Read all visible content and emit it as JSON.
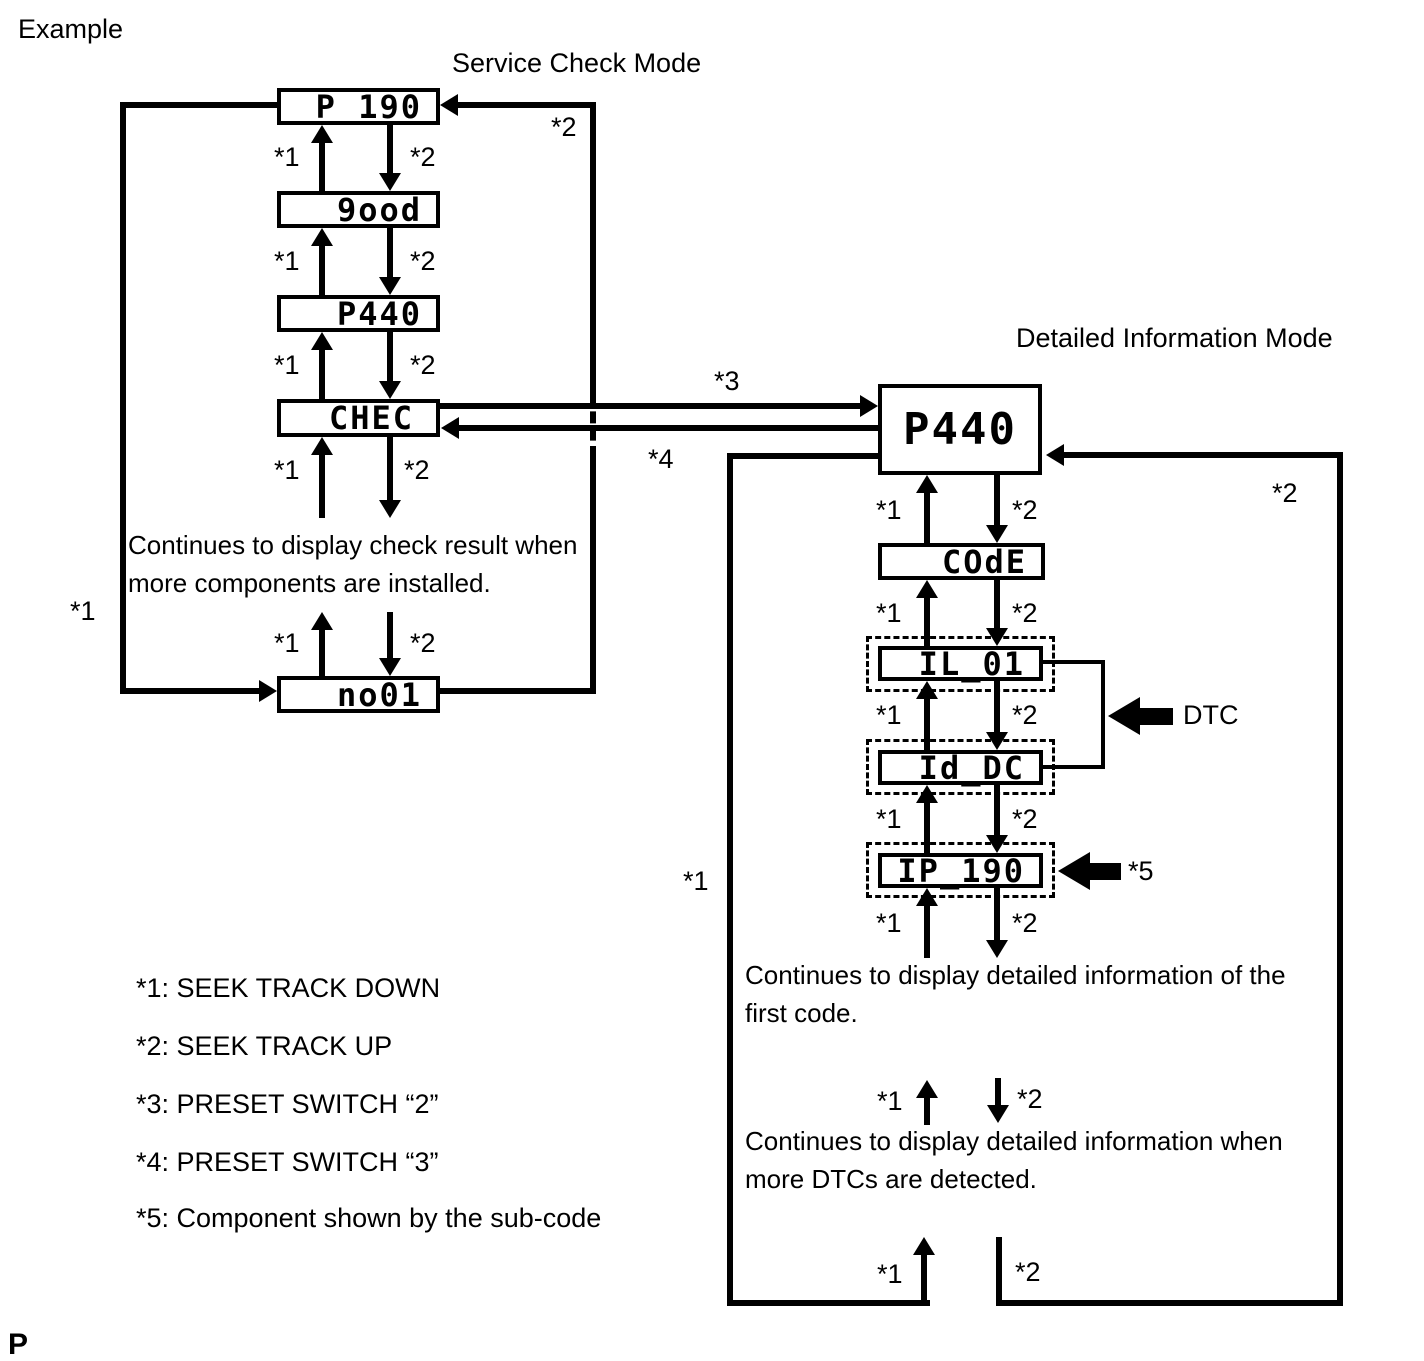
{
  "example_label": "Example",
  "footer_letter": "P",
  "markers": {
    "s1": "*1",
    "s2": "*2",
    "s3": "*3",
    "s4": "*4",
    "s5": "*5"
  },
  "service_check": {
    "title": "Service Check Mode",
    "displays": {
      "p190": "P 190",
      "good": "9ood",
      "p440": "P440",
      "chec": "CHEC",
      "no01": "no01"
    },
    "note": "Continues to display check result when more components are installed."
  },
  "detailed_info": {
    "title": "Detailed Information Mode",
    "displays": {
      "p440": "P440",
      "code": "COdE",
      "il01": "IL_01",
      "iddc": "Id_DC",
      "ip190": "IP_190"
    },
    "dtc_label": "DTC",
    "note_first": "Continues to display detailed information of the first code.",
    "note_more": "Continues to display detailed information when more DTCs are detected."
  },
  "legend": {
    "items": [
      "*1: SEEK TRACK DOWN",
      "*2: SEEK TRACK UP",
      "*3: PRESET SWITCH “2”",
      "*4: PRESET SWITCH “3”",
      "*5: Component shown by the sub-code"
    ]
  }
}
